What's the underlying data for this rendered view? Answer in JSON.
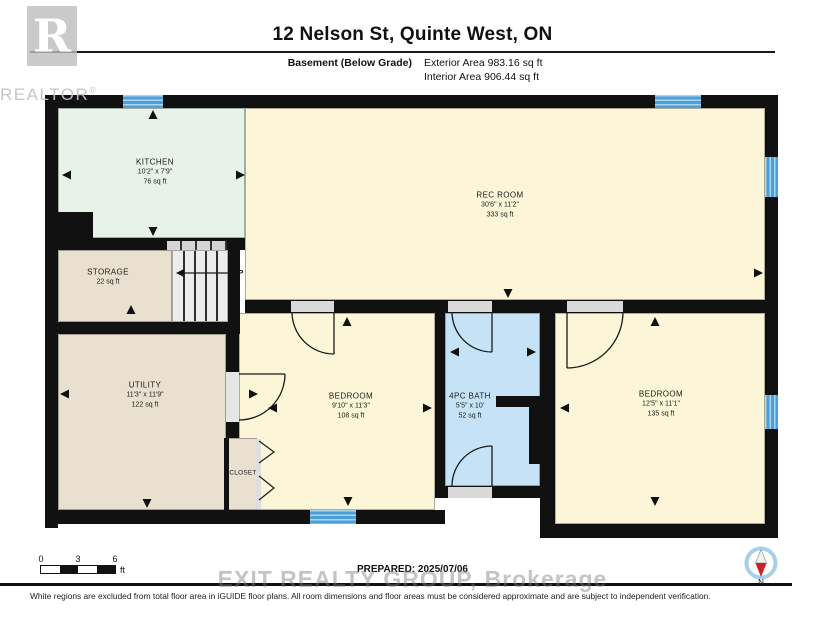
{
  "header": {
    "title": "12 Nelson St, Quinte West, ON",
    "floor_label": "Basement (Below Grade)",
    "exterior_area": "Exterior Area 983.16 sq ft",
    "interior_area": "Interior Area 906.44 sq ft"
  },
  "watermarks": {
    "realtor_r": "R",
    "realtor_text": "REALTOR",
    "realtor_reg": "®",
    "brokerage_text": "EXIT REALTY GROUP, Brokerage"
  },
  "rooms": {
    "kitchen": {
      "name": "KITCHEN",
      "dims": "10'2\" x 7'9\"",
      "area": "76 sq ft"
    },
    "rec_room": {
      "name": "REC ROOM",
      "dims": "30'6\" x 11'2\"",
      "area": "333 sq ft"
    },
    "storage": {
      "name": "STORAGE",
      "area": "22 sq ft"
    },
    "utility": {
      "name": "UTILITY",
      "dims": "11'3\" x 11'9\"",
      "area": "122 sq ft"
    },
    "bedroom_middle": {
      "name": "BEDROOM",
      "dims": "9'10\" x 11'3\"",
      "area": "108 sq ft"
    },
    "bath": {
      "name": "4PC BATH",
      "dims": "5'5\" x 10'",
      "area": "52 sq ft"
    },
    "bedroom_right": {
      "name": "BEDROOM",
      "dims": "12'5\" x 11'1\"",
      "area": "135 sq ft"
    },
    "closet": {
      "name": "CLOSET"
    }
  },
  "stairs": {
    "up_label": "UP",
    "up_arrow_icon": "◄"
  },
  "footer": {
    "scale_ticks": {
      "t0": "0",
      "t1": "3",
      "t2": "6"
    },
    "scale_unit": "ft",
    "prepared": "PREPARED: 2025/07/06",
    "compass": "N",
    "disclaimer": "White regions are excluded from total floor area in iGUIDE floor plans. All room dimensions and floor areas must be considered approximate and are subject to independent verification."
  },
  "colors": {
    "room_cream": "#fdf5d7",
    "room_mint": "#e7f2e9",
    "room_tan": "#e9e0d0",
    "room_blue": "#c6e2f7",
    "window_blue": "#4aa0d6",
    "wall_black": "#111111"
  }
}
